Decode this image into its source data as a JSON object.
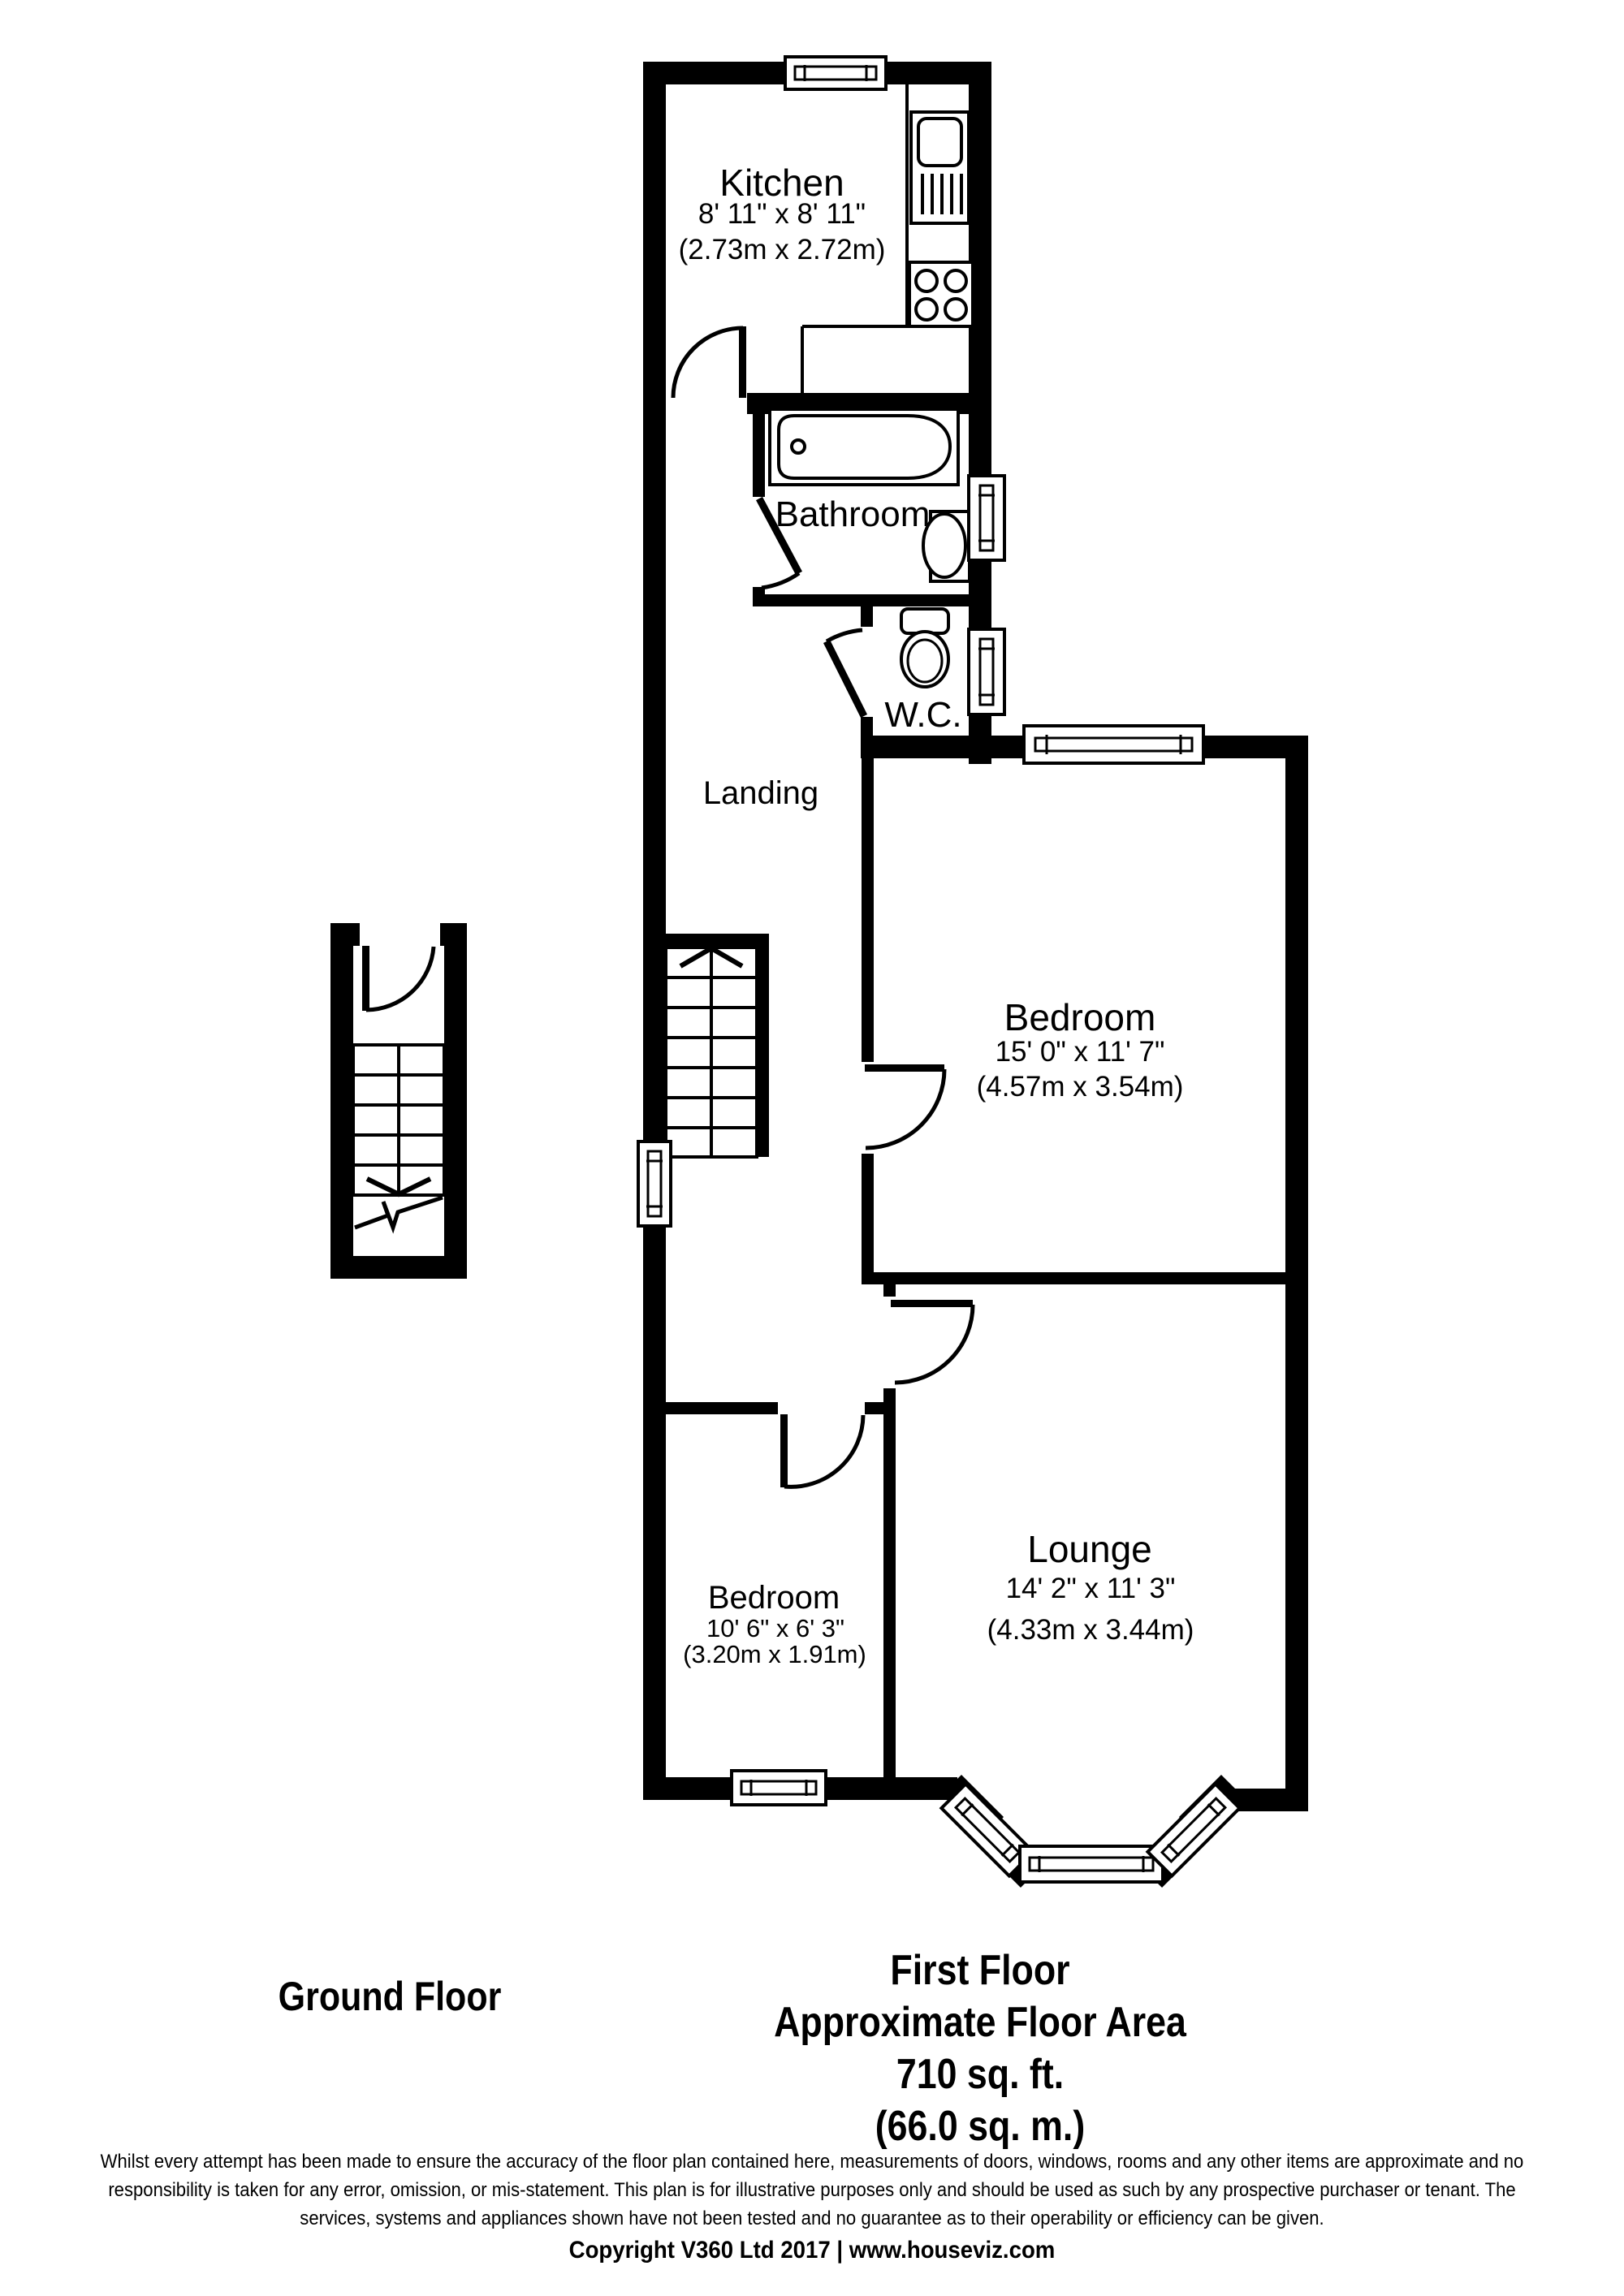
{
  "colors": {
    "wall": "#000000",
    "background": "#ffffff",
    "text": "#000000"
  },
  "rooms": {
    "kitchen": {
      "name": "Kitchen",
      "imperial": "8' 11\" x 8' 11\"",
      "metric": "(2.73m x 2.72m)"
    },
    "bathroom": {
      "name": "Bathroom"
    },
    "wc": {
      "name": "W.C."
    },
    "landing": {
      "name": "Landing"
    },
    "bedroom1": {
      "name": "Bedroom",
      "imperial": "15' 0\" x 11' 7\"",
      "metric": "(4.57m x 3.54m)"
    },
    "lounge": {
      "name": "Lounge",
      "imperial": "14' 2\" x 11' 3\"",
      "metric": "(4.33m x 3.44m)"
    },
    "bedroom2": {
      "name": "Bedroom",
      "imperial": "10' 6\" x 6' 3\"",
      "metric": "(3.20m x 1.91m)"
    }
  },
  "footer": {
    "ground_floor_label": "Ground Floor",
    "first_floor_title": "First Floor",
    "area_label": "Approximate Floor Area",
    "area_imperial": "710 sq. ft.",
    "area_metric": "(66.0 sq. m.)"
  },
  "disclaimer": {
    "line1": "Whilst every attempt has been made to ensure the accuracy of the floor plan contained here, measurements of doors, windows, rooms and any other items are approximate and no",
    "line2": "responsibility is taken for any error, omission, or mis-statement. This plan is for illustrative purposes only and should be used as such by any prospective purchaser or tenant. The",
    "line3": "services, systems and appliances shown have not been tested and no guarantee as to their operability or efficiency can be given."
  },
  "copyright": "Copyright V360 Ltd 2017 | www.houseviz.com"
}
